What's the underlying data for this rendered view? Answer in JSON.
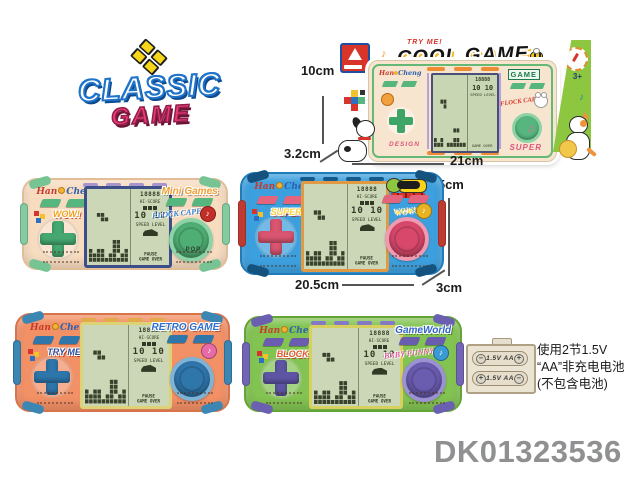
{
  "product_code": "DK01323536",
  "classic_logo": {
    "line1": "CLASSIC",
    "line2": "GAME"
  },
  "decor": {
    "note_single": "♪",
    "note_double": "♫"
  },
  "box": {
    "try_me": "TRY ME!",
    "title": "COOL GAME",
    "age": "3+",
    "brand_left": "Han",
    "brand_right": "Cheng",
    "left_button_label": "DESIGN",
    "right_logo": "GAME",
    "right_sticker": "FLOCK CAPE",
    "right_button_label": "SUPER"
  },
  "dims": {
    "box_height": "10cm",
    "box_depth": "3.2cm",
    "box_width": "21cm",
    "unit_height": "9.5cm",
    "unit_width": "20.5cm",
    "unit_depth": "3cm"
  },
  "lcd": {
    "score": "18888",
    "hi_score": "HI-SCORE",
    "level": "10 10",
    "speed_level": "SPEED LEVEL",
    "pause": "PAUSE",
    "game_over": "GAME OVER"
  },
  "consoles": [
    {
      "name": "cream",
      "brand_left": "Han",
      "brand_right": "Cheng",
      "left_sticker": "WOW!",
      "right_logo": "Mini Games",
      "right_sticker": "FLOCK CAPE",
      "bottom_label": "POP",
      "mascot": false,
      "colors": {
        "body": "#f7dcc0",
        "edge": "#e2bd98",
        "grip": "#84cba0",
        "cap": "#76c394",
        "slat": "#a795cc",
        "btn": "#57b67e",
        "dpad": "#46a870",
        "stickerL": "#f0a11a",
        "logoR": "#f39c2f",
        "stickerR": "#3a7fd0",
        "btnBig": "#4fae73",
        "btnRing": "#8ed3a8",
        "frame": "#3d4f88",
        "stk": "#c22f28"
      }
    },
    {
      "name": "blue",
      "brand_left": "Han",
      "brand_right": "Cheng",
      "left_sticker": "SUPER",
      "right_logo": "",
      "right_sticker": "WOW!",
      "bottom_label": "",
      "mascot": true,
      "colors": {
        "body": "#3da0de",
        "edge": "#1f7cba",
        "grip": "#bf3a31",
        "cap": "#14537f",
        "slat": "#165a8c",
        "btn": "#e4647e",
        "dpad": "#d95570",
        "stickerL": "#ffd23e",
        "logoR": "#ffffff",
        "stickerR": "#ffd23e",
        "btnBig": "#d8486b",
        "btnRing": "#ef9ab0",
        "frame": "#e09a43",
        "stk": "#e8b320"
      }
    },
    {
      "name": "orange",
      "brand_left": "Han",
      "brand_right": "Cheng",
      "left_sticker": "TRY ME!!",
      "right_logo": "RETRO GAME",
      "right_sticker": "",
      "bottom_label": "",
      "mascot": false,
      "colors": {
        "body": "#f29066",
        "edge": "#d9744a",
        "grip": "#3c86b4",
        "cap": "#3c86b4",
        "slat": "#e2aa4b",
        "btn": "#2f76ab",
        "dpad": "#2f76ab",
        "stickerL": "#2f4f9e",
        "logoR": "#2f6fd0",
        "stickerR": "#d8342a",
        "btnBig": "#2f76ab",
        "btnRing": "#7fb3d6",
        "frame": "#ded276",
        "stk": "#e86ba8"
      }
    },
    {
      "name": "green",
      "brand_left": "Han",
      "brand_right": "Cheng",
      "left_sticker": "BLOCK",
      "right_logo": "GameWorld",
      "right_sticker": "BABY FUNNY",
      "bottom_label": "",
      "mascot": false,
      "colors": {
        "body": "#82c352",
        "edge": "#63a437",
        "grip": "#7265b5",
        "cap": "#6a5fb0",
        "slat": "#8578c4",
        "btn": "#6a5caf",
        "dpad": "#5f55a5",
        "stickerL": "#e2572b",
        "logoR": "#2f63c8",
        "stickerR": "#e85fa0",
        "btnBig": "#6a5caf",
        "btnRing": "#9c92d2",
        "frame": "#d8d05e",
        "stk": "#3a9ad4"
      }
    }
  ],
  "battery": {
    "cell_label": "1.5V AA",
    "minus": "−",
    "plus": "+",
    "note_line1": "使用2节1.5V",
    "note_line2": "“AA”非充电电池",
    "note_line3": "(不包含电池)"
  }
}
